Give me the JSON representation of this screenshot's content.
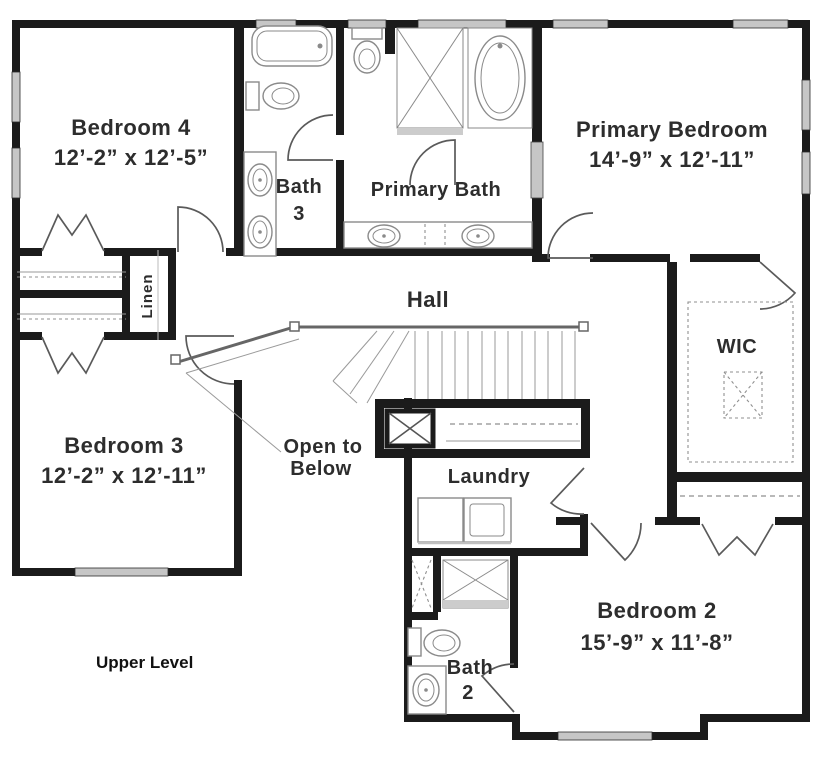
{
  "floor_plan": {
    "level_label": "Upper Level",
    "rooms": {
      "bedroom4": {
        "name": "Bedroom 4",
        "dims": "12’-2” x 12’-5”"
      },
      "bedroom3": {
        "name": "Bedroom 3",
        "dims": "12’-2” x 12’-11”"
      },
      "bedroom2": {
        "name": "Bedroom 2",
        "dims": "15’-9” x 11’-8”"
      },
      "primary_bedroom": {
        "name": "Primary Bedroom",
        "dims": "14’-9” x 12’-11”"
      },
      "primary_bath": {
        "name": "Primary Bath"
      },
      "bath3": {
        "line1": "Bath",
        "line2": "3"
      },
      "bath2": {
        "line1": "Bath",
        "line2": "2"
      },
      "hall": {
        "name": "Hall"
      },
      "laundry": {
        "name": "Laundry"
      },
      "wic": {
        "name": "WIC"
      },
      "linen": {
        "name": "Linen"
      },
      "open_to_below": {
        "line1": "Open to",
        "line2": "Below"
      }
    },
    "colors": {
      "wall": "#1b1b1b",
      "window": "#c6c6c6",
      "line": "#9a9a9a",
      "text": "#2d2d2d",
      "background": "#ffffff"
    }
  }
}
